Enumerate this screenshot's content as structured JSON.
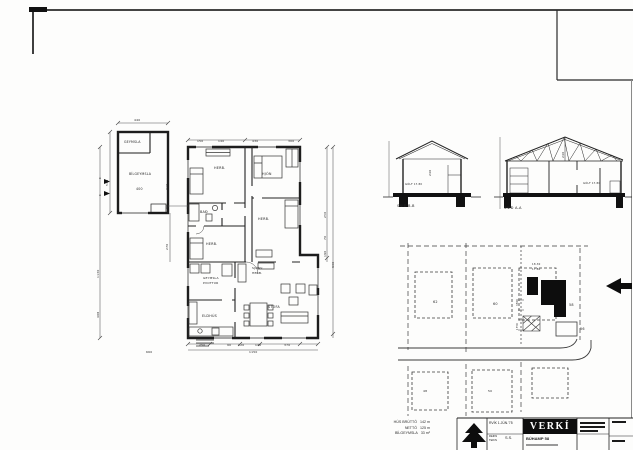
{
  "paper": {
    "bg": "#fdfdfc",
    "ink": "#222222"
  },
  "stats": {
    "rows": [
      {
        "label": "HÚS BRÚTTÓ",
        "value": "142 m"
      },
      {
        "label": "NETTÓ",
        "value": "125 m"
      },
      {
        "label": "BÍLGEYMSLA",
        "value": "33 m²"
      }
    ]
  },
  "title_block": {
    "logo": "VERKÍ",
    "date": "RVÍK 1.JÚN.'75",
    "field1": "REIKN",
    "field2": "TEIKN",
    "initials": "S.S.",
    "project": "BÚHAMP 58"
  },
  "labels": [
    {
      "t": "GEYMSLA",
      "x": 124,
      "y": 141,
      "s": 3.2,
      "n": "room-label-geymsla-garage"
    },
    {
      "t": "BÍLGEYMSLA",
      "x": 129,
      "y": 173,
      "s": 3.2,
      "n": "room-label-bilgeymsla"
    },
    {
      "t": "HERB.",
      "x": 214,
      "y": 167,
      "s": 3.4,
      "n": "room-label-herb-1"
    },
    {
      "t": "HJÓN",
      "x": 262,
      "y": 173,
      "s": 3.4,
      "n": "room-label-hjon"
    },
    {
      "t": "BAÐ",
      "x": 200,
      "y": 211,
      "s": 3.4,
      "n": "room-label-bad"
    },
    {
      "t": "HERB.",
      "x": 206,
      "y": 243,
      "s": 3.4,
      "n": "room-label-herb-2"
    },
    {
      "t": "HERB.",
      "x": 258,
      "y": 218,
      "s": 3.4,
      "n": "room-label-herb-3"
    },
    {
      "t": "GEYMSLA",
      "x": 203,
      "y": 277,
      "s": 3,
      "n": "room-label-geymsla"
    },
    {
      "t": "ÞVOTTUR",
      "x": 203,
      "y": 282,
      "s": 3,
      "n": "room-label-thvottur"
    },
    {
      "t": "ELDHÚS",
      "x": 202,
      "y": 315,
      "s": 3.4,
      "n": "room-label-eldhus"
    },
    {
      "t": "SJÓNV.",
      "x": 252,
      "y": 267,
      "s": 3,
      "n": "room-label-sjonv"
    },
    {
      "t": "HERB.",
      "x": 252,
      "y": 272,
      "s": 3,
      "n": "room-label-sjonv-herb"
    },
    {
      "t": "STOFA",
      "x": 268,
      "y": 306,
      "s": 3.4,
      "n": "room-label-stofa"
    },
    {
      "t": "400",
      "x": 136,
      "y": 188,
      "s": 3.2,
      "n": "dim-label"
    },
    {
      "t": "440",
      "x": 134,
      "y": 119,
      "s": 3,
      "n": "dim-label"
    },
    {
      "t": "570",
      "x": 106,
      "y": 186,
      "s": 3,
      "r": -90,
      "n": "dim-label"
    },
    {
      "t": "1130",
      "x": 97,
      "y": 278,
      "s": 3,
      "r": -90,
      "n": "dim-label"
    },
    {
      "t": "408",
      "x": 97,
      "y": 318,
      "s": 3,
      "r": -90,
      "n": "dim-label"
    },
    {
      "t": "150",
      "x": 197,
      "y": 140,
      "s": 3,
      "n": "dim-label"
    },
    {
      "t": "140",
      "x": 218,
      "y": 140,
      "s": 3,
      "n": "dim-label"
    },
    {
      "t": "430",
      "x": 252,
      "y": 140,
      "s": 3,
      "n": "dim-label"
    },
    {
      "t": "300",
      "x": 288,
      "y": 140,
      "s": 3,
      "n": "dim-label"
    },
    {
      "t": "310",
      "x": 166,
      "y": 190,
      "s": 3,
      "r": -90,
      "n": "dim-label"
    },
    {
      "t": "90",
      "x": 166,
      "y": 209,
      "s": 3,
      "r": -90,
      "n": "dim-label"
    },
    {
      "t": "270",
      "x": 166,
      "y": 250,
      "s": 3,
      "r": -90,
      "n": "dim-label"
    },
    {
      "t": "250",
      "x": 199,
      "y": 344,
      "s": 3,
      "n": "dim-label"
    },
    {
      "t": "90",
      "x": 227,
      "y": 344,
      "s": 3,
      "n": "dim-label"
    },
    {
      "t": "120",
      "x": 238,
      "y": 344,
      "s": 3,
      "n": "dim-label"
    },
    {
      "t": "140",
      "x": 255,
      "y": 344,
      "s": 3,
      "n": "dim-label"
    },
    {
      "t": "370",
      "x": 284,
      "y": 344,
      "s": 3,
      "n": "dim-label"
    },
    {
      "t": "1150",
      "x": 249,
      "y": 351,
      "s": 3,
      "n": "dim-label"
    },
    {
      "t": "660",
      "x": 146,
      "y": 351,
      "s": 3,
      "n": "dim-label"
    },
    {
      "t": "250",
      "x": 324,
      "y": 218,
      "s": 3,
      "r": -90,
      "n": "dim-label"
    },
    {
      "t": "70",
      "x": 324,
      "y": 240,
      "s": 3,
      "r": -90,
      "n": "dim-label"
    },
    {
      "t": "190",
      "x": 324,
      "y": 257,
      "s": 3,
      "r": -90,
      "n": "dim-label"
    },
    {
      "t": "930",
      "x": 332,
      "y": 268,
      "s": 3,
      "r": -90,
      "n": "dim-label"
    },
    {
      "t": "SNIÐ B-B",
      "x": 397,
      "y": 205,
      "s": 3.6,
      "n": "section-label-bb"
    },
    {
      "t": "SNIÐ A-A",
      "x": 504,
      "y": 207,
      "s": 3.6,
      "n": "section-label-aa"
    },
    {
      "t": "240",
      "x": 429,
      "y": 176,
      "s": 3,
      "r": -90,
      "n": "dim-label"
    },
    {
      "t": "240",
      "x": 562,
      "y": 158,
      "s": 3,
      "r": -90,
      "n": "dim-label"
    },
    {
      "t": "GÓLF 17.80",
      "x": 405,
      "y": 184,
      "s": 2.6,
      "n": "elev-label"
    },
    {
      "t": "GÓLF 17.80",
      "x": 583,
      "y": 183,
      "s": 2.6,
      "n": "elev-label"
    },
    {
      "t": "62",
      "x": 433,
      "y": 301,
      "s": 3.4,
      "n": "plot-label-62"
    },
    {
      "t": "60",
      "x": 493,
      "y": 303,
      "s": 3.4,
      "n": "plot-label-60"
    },
    {
      "t": "58",
      "x": 569,
      "y": 304,
      "s": 3.4,
      "n": "plot-label-58"
    },
    {
      "t": "56",
      "x": 580,
      "y": 328,
      "s": 3.4,
      "n": "plot-label-56"
    },
    {
      "t": "48",
      "x": 423,
      "y": 390,
      "s": 3,
      "n": "plot-label-48"
    },
    {
      "t": "50",
      "x": 488,
      "y": 390,
      "s": 3,
      "n": "plot-label-50"
    },
    {
      "t": "18.30",
      "x": 532,
      "y": 264,
      "s": 2.6,
      "n": "elev-label"
    },
    {
      "t": "17.80",
      "x": 532,
      "y": 269,
      "s": 2.6,
      "n": "elev-label"
    },
    {
      "t": "3500",
      "x": 517,
      "y": 306,
      "s": 2.4,
      "r": -90,
      "n": "dim-label"
    },
    {
      "t": "1750",
      "x": 517,
      "y": 330,
      "s": 2.4,
      "r": -90,
      "n": "dim-label"
    },
    {
      "t": "A",
      "x": 99,
      "y": 177,
      "s": 3,
      "n": "section-cut-label-a"
    },
    {
      "t": "A",
      "x": 99,
      "y": 194,
      "s": 3,
      "n": "section-cut-label-a"
    }
  ]
}
